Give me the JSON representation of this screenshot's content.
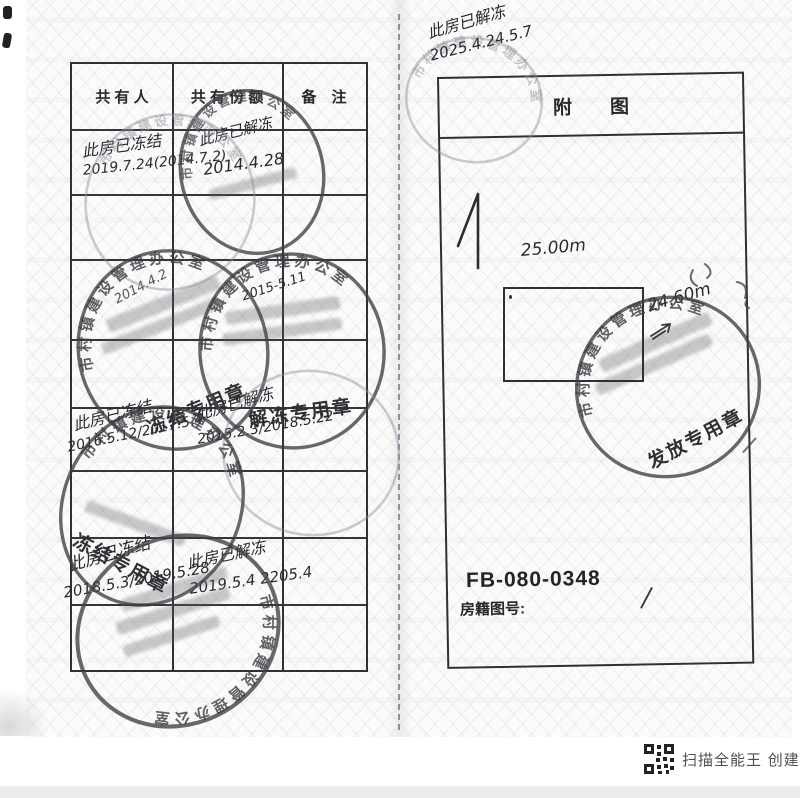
{
  "doc": {
    "table": {
      "h1": "共 有 人",
      "h2": "共 有 份 额",
      "h3": "备　注"
    },
    "hw": {
      "r1c1a": "此房已冻结",
      "r1c1b": "2019.7.24(2014.7.2)",
      "r1c2a": "此房已解冻",
      "r1c2b": "2014.4.28",
      "c_note": "2014.4.2",
      "d_note": "2015-5.11",
      "r5c1a": "此房已冻结",
      "r5c1b": "2016.5.12/2017.5.4",
      "r5c2a": "此房已解冻",
      "r5c2b": "2015.2.3/2018.5.22",
      "r7c1a": "此房已冻结",
      "r7c1b": "2018.5.3/2019.5.28",
      "r7c2a": "此房已解冻",
      "r7c2b": "2019.5.4 2205.4"
    },
    "stamps": {
      "ring": "市村镇建设管理办公室",
      "freeze": "冻结专用章",
      "unfreeze": "解冻专用章",
      "issue": "发放专用章"
    },
    "right": {
      "title": "附图",
      "noteA": "此房已解冻",
      "noteB": "2025.4.24.5.7",
      "dimTop": "25.00m",
      "dimRight": "24.60m",
      "code": "FB-080-0348",
      "mapLabel": "房籍图号:"
    },
    "footer": {
      "watermark": "扫描全能王 创建"
    }
  }
}
